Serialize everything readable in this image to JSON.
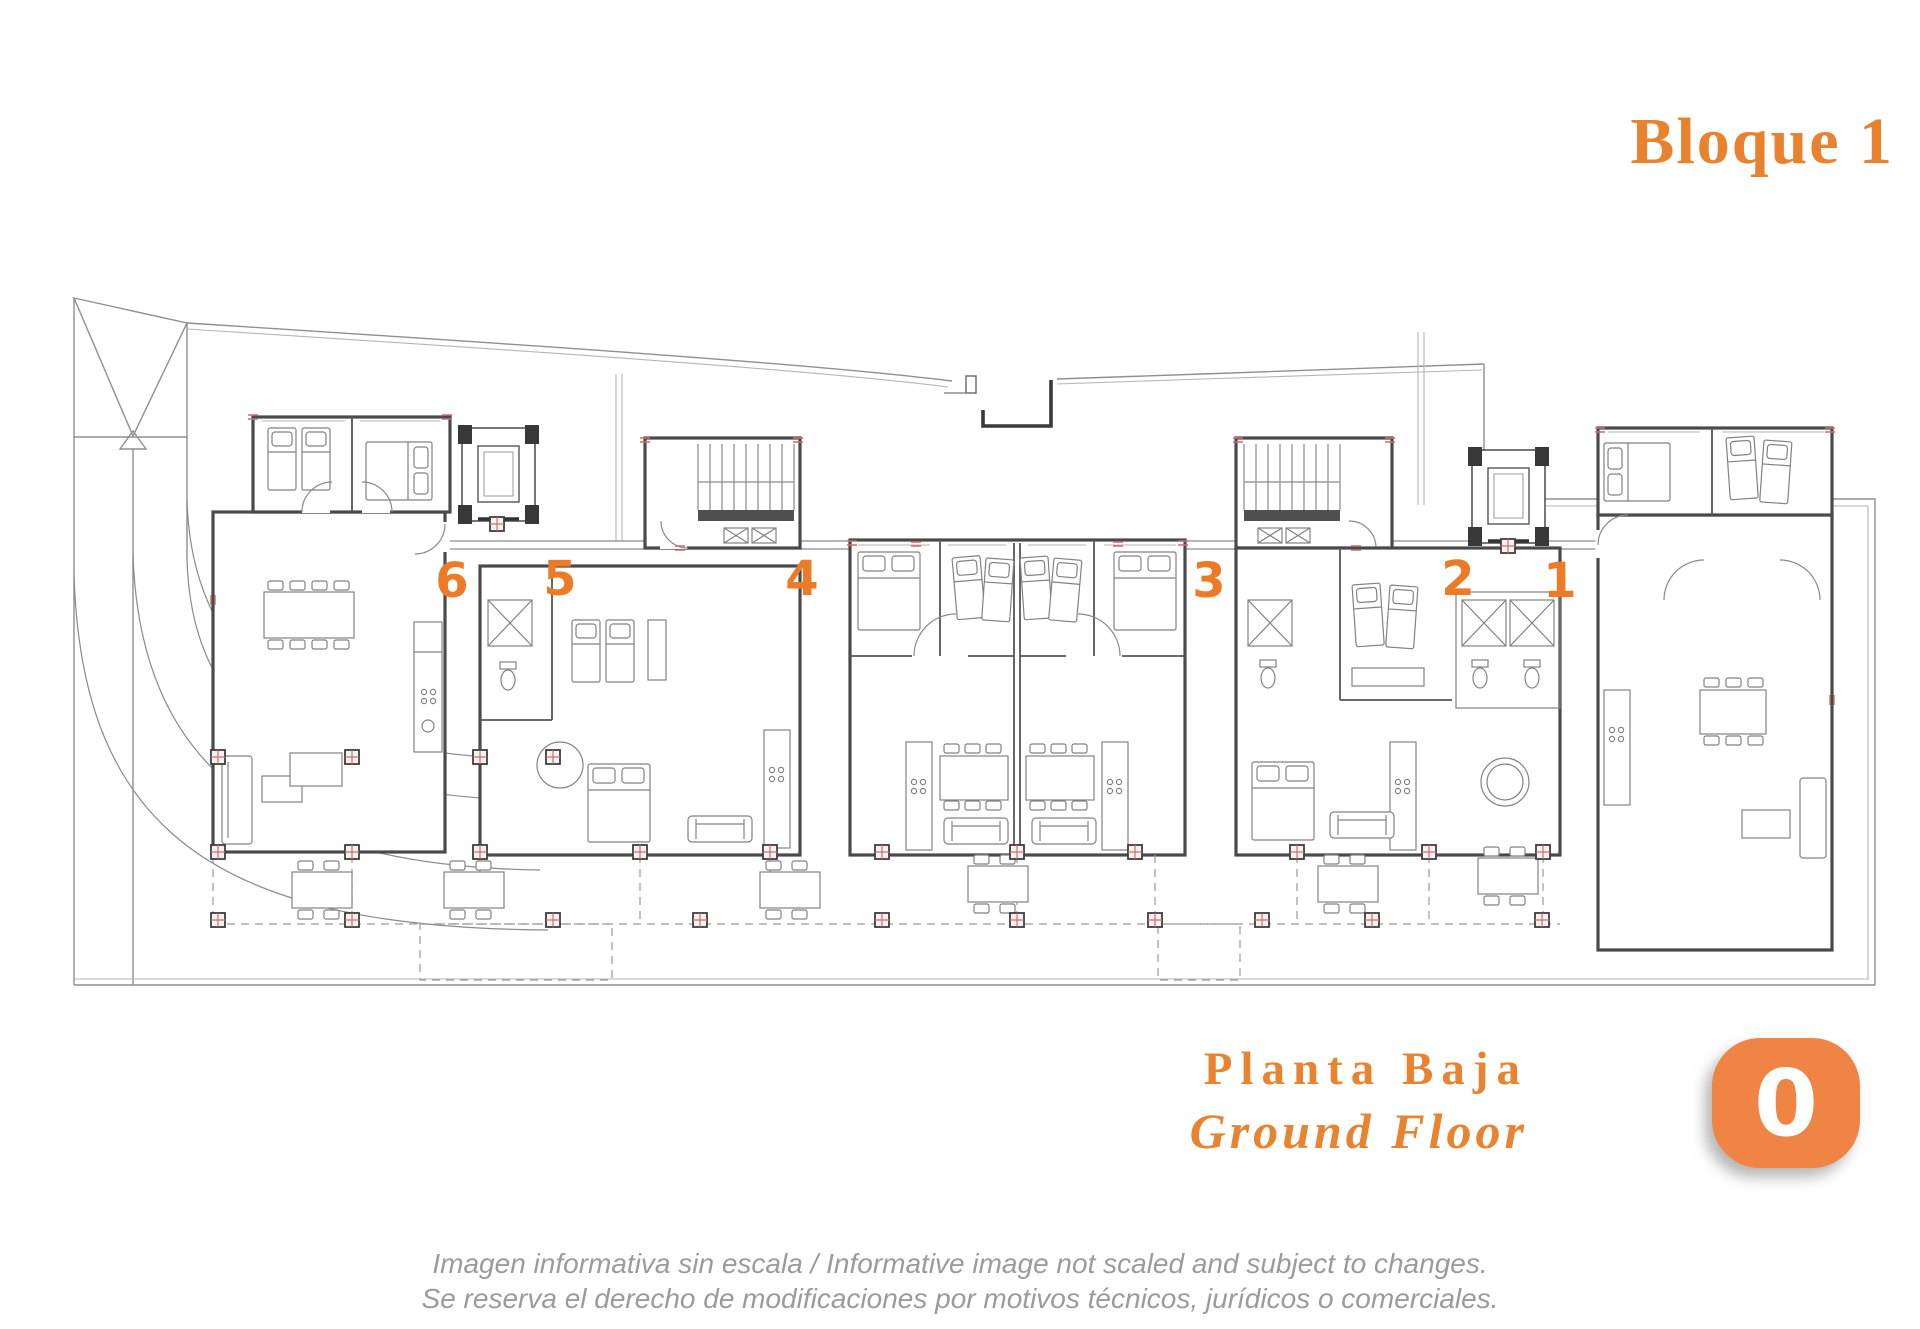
{
  "header": {
    "title": "Bloque 1"
  },
  "plan": {
    "apartments": [
      {
        "label": "6"
      },
      {
        "label": "5"
      },
      {
        "label": "4"
      },
      {
        "label": "3"
      },
      {
        "label": "2"
      },
      {
        "label": "1"
      }
    ],
    "accent_color": "#ED7A27"
  },
  "footer": {
    "floor_name_es": "Planta Baja",
    "floor_name_en": "Ground Floor",
    "level_badge": "0"
  },
  "disclaimer": {
    "line1": "Imagen informativa sin escala /  Informative image not scaled and subject to changes.",
    "line2": "Se reserva el derecho de modificaciones por motivos técnicos, jurídicos o comerciales."
  },
  "colors": {
    "accent": "#E8822F",
    "badge": "#F08445",
    "muted_text": "#9B9B9B"
  }
}
